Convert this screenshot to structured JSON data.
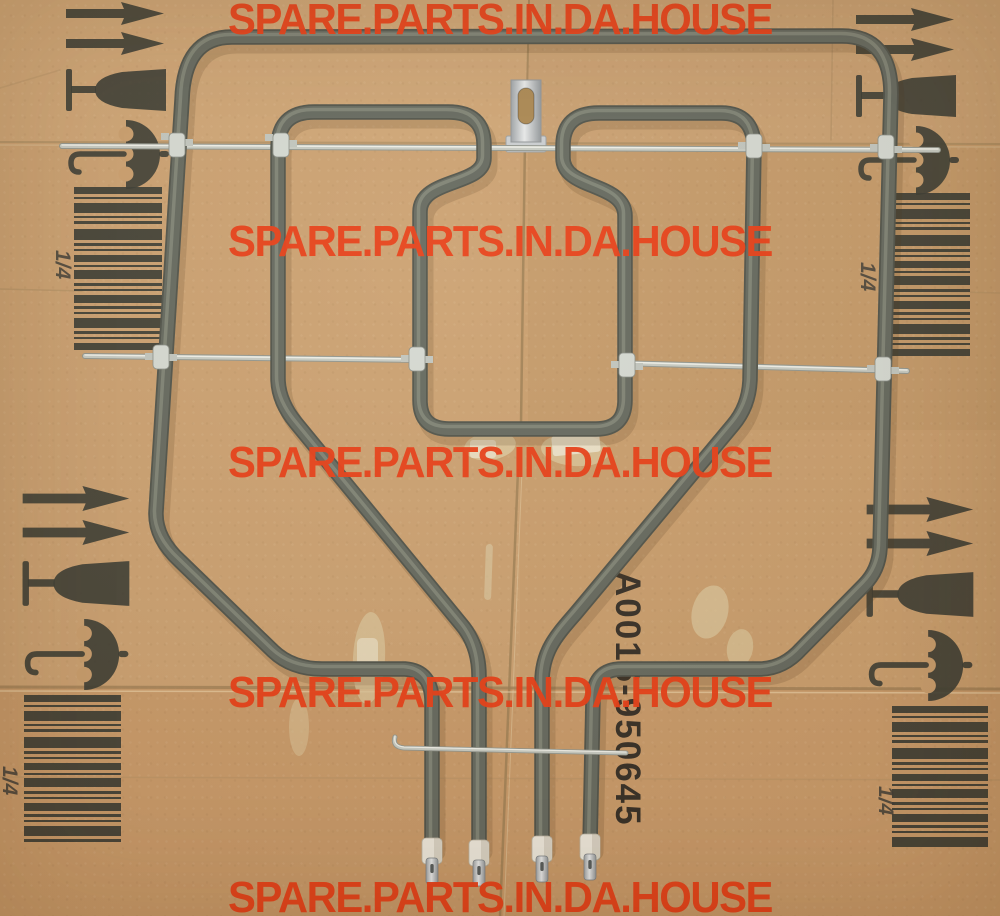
{
  "watermark": {
    "text": "SPARE.PARTS.IN.DA.HOUSE",
    "color": "#e83a12",
    "rows": 5
  },
  "part_label": {
    "text": "A0016-950645",
    "color": "#1b1a18"
  },
  "shipping_marks": {
    "fraction": "1/4",
    "ink_color": "#34362f",
    "icons": [
      "this-way-up-arrow-icon",
      "this-way-up-arrow-icon",
      "fragile-wine-glass-icon",
      "keep-dry-umbrella-icon",
      "barcode-icon"
    ]
  },
  "barcode_pattern": [
    [
      7,
      3
    ],
    [
      2,
      4
    ],
    [
      10,
      3
    ],
    [
      2,
      3
    ],
    [
      3,
      5
    ],
    [
      11,
      3
    ],
    [
      3,
      3
    ],
    [
      2,
      4
    ],
    [
      7,
      3
    ],
    [
      2,
      3
    ],
    [
      9,
      4
    ],
    [
      3,
      3
    ],
    [
      2,
      4
    ],
    [
      8,
      3
    ],
    [
      3,
      3
    ],
    [
      2,
      4
    ],
    [
      10,
      3
    ],
    [
      3,
      3
    ],
    [
      2,
      4
    ],
    [
      7,
      4
    ]
  ],
  "colors": {
    "cardboard": "#c89c6b",
    "tube": "#60655c",
    "tube_edge": "#4b4f47",
    "tube_highlight": "#828779",
    "rod": "#c6cbc4",
    "clamp": "#d4d9d3",
    "insulator": "#edeadf"
  }
}
